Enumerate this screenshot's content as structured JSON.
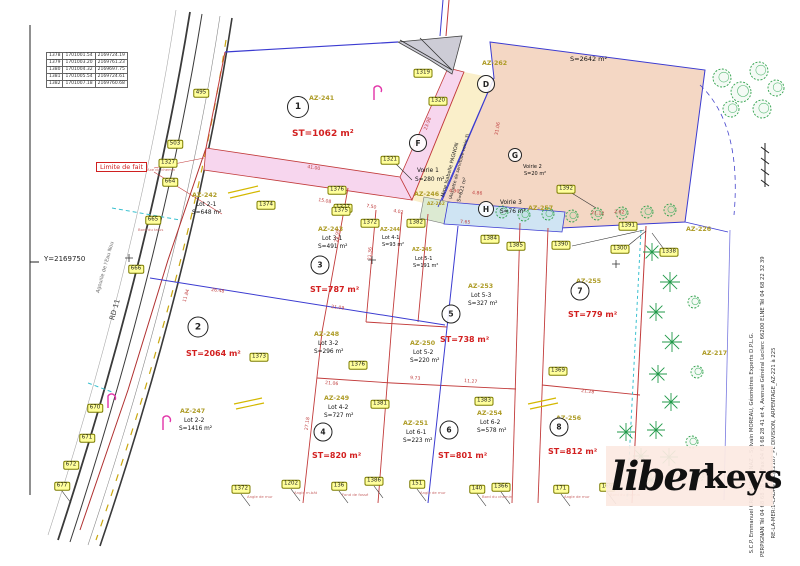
{
  "colors": {
    "red_line": "#c23b3b",
    "blue_line": "#3b3bd1",
    "pink_voirie": "#f7d6ee",
    "cream": "#faefca",
    "salmon": "#f4d7c4",
    "light_blue": "#cfe4f3",
    "green_tree": "#2fa14b",
    "point_yellow": "#ffff9c",
    "logo_bg": "#fbe9e2",
    "az_olive": "#ad9b25",
    "st_red": "#d21f1f"
  },
  "frame": {
    "y_label": "Y=2169750"
  },
  "road": {
    "rd": "RD 11",
    "stream": "Agouille de l'Eau Nou",
    "limite": "Limite de fait"
  },
  "coord_table": {
    "rows": [
      [
        "1378",
        "1701001.54",
        "2169724.19"
      ],
      [
        "1379",
        "1701003.20",
        "2169761.23"
      ],
      [
        "1380",
        "1701004.32",
        "2169697.75"
      ],
      [
        "1381",
        "1701005.54",
        "2169724.61"
      ],
      [
        "1382",
        "1701007.18",
        "2169760.68"
      ]
    ]
  },
  "logo": {
    "script": "liber",
    "bold": "keys"
  },
  "firm_lines": [
    "S.C.P. Emmanuel CRETIN-MAITENAZ - Sylvain MOREAU, Géomètres Experts D.P.L.G.",
    "PERPIGNAN Tél 04 68 68 28 40 - Fax 04 68 68 28 41 et 4, Avenue Général Leclerc 66200 ELNE Tél 04 68 22 32 39",
    "RE-LA-MER:1-CADASTRE/22187_PL DIVISION, ARPENTAGE_AZ-221 à 225"
  ],
  "pagnon": [
    "Mme Isabelle PAGNON",
    "(Assiette de servitude-voirie 3)",
    "S=621 m²"
  ],
  "circles": [
    {
      "n": "1",
      "x": 298,
      "y": 107,
      "d": 20
    },
    {
      "n": "2",
      "x": 198,
      "y": 327,
      "d": 19
    },
    {
      "n": "3",
      "x": 320,
      "y": 265,
      "d": 17
    },
    {
      "n": "4",
      "x": 323,
      "y": 432,
      "d": 17
    },
    {
      "n": "5",
      "x": 451,
      "y": 314,
      "d": 17
    },
    {
      "n": "6",
      "x": 449,
      "y": 430,
      "d": 17
    },
    {
      "n": "7",
      "x": 580,
      "y": 291,
      "d": 17
    },
    {
      "n": "8",
      "x": 559,
      "y": 427,
      "d": 17
    },
    {
      "n": "D",
      "x": 486,
      "y": 84,
      "d": 16
    },
    {
      "n": "F",
      "x": 418,
      "y": 143,
      "d": 16
    },
    {
      "n": "G",
      "x": 515,
      "y": 155,
      "d": 12
    },
    {
      "n": "H",
      "x": 486,
      "y": 209,
      "d": 14
    }
  ],
  "map_texts": [
    {
      "t": "AZ-241",
      "x": 309,
      "y": 96,
      "cls": "az"
    },
    {
      "t": "ST=1062 m²",
      "x": 292,
      "y": 130,
      "cls": "st",
      "f": 9
    },
    {
      "t": "AZ-242",
      "x": 192,
      "y": 193,
      "cls": "az"
    },
    {
      "t": "Lot 2-1",
      "x": 196,
      "y": 202,
      "cls": "k"
    },
    {
      "t": "S=648 m²",
      "x": 192,
      "y": 210,
      "cls": "k"
    },
    {
      "t": "AZ-243",
      "x": 318,
      "y": 227,
      "cls": "az"
    },
    {
      "t": "Lot 3-1",
      "x": 322,
      "y": 236,
      "cls": "k"
    },
    {
      "t": "S=491 m²",
      "x": 318,
      "y": 244,
      "cls": "k"
    },
    {
      "t": "AZ-244",
      "x": 380,
      "y": 228,
      "cls": "az",
      "f": 5
    },
    {
      "t": "Lot 4-1",
      "x": 382,
      "y": 236,
      "cls": "k",
      "f": 5
    },
    {
      "t": "S=93 m²",
      "x": 382,
      "y": 243,
      "cls": "k",
      "f": 5
    },
    {
      "t": "AZ-245",
      "x": 412,
      "y": 248,
      "cls": "az",
      "f": 5
    },
    {
      "t": "Lot 5-1",
      "x": 415,
      "y": 257,
      "cls": "k",
      "f": 5
    },
    {
      "t": "S=191 m²",
      "x": 413,
      "y": 264,
      "cls": "k",
      "f": 5
    },
    {
      "t": "AZ-246",
      "x": 414,
      "y": 192,
      "cls": "az"
    },
    {
      "t": "AZ-247",
      "x": 180,
      "y": 409,
      "cls": "az"
    },
    {
      "t": "Lot 2-2",
      "x": 184,
      "y": 418,
      "cls": "k"
    },
    {
      "t": "S=1416 m²",
      "x": 179,
      "y": 426,
      "cls": "k"
    },
    {
      "t": "AZ-248",
      "x": 314,
      "y": 332,
      "cls": "az"
    },
    {
      "t": "Lot 3-2",
      "x": 318,
      "y": 341,
      "cls": "k"
    },
    {
      "t": "S=296 m²",
      "x": 314,
      "y": 349,
      "cls": "k"
    },
    {
      "t": "AZ-249",
      "x": 324,
      "y": 396,
      "cls": "az"
    },
    {
      "t": "Lot 4-2",
      "x": 328,
      "y": 405,
      "cls": "k"
    },
    {
      "t": "S=727 m²",
      "x": 324,
      "y": 413,
      "cls": "k"
    },
    {
      "t": "AZ-250",
      "x": 410,
      "y": 341,
      "cls": "az"
    },
    {
      "t": "Lot 5-2",
      "x": 413,
      "y": 350,
      "cls": "k"
    },
    {
      "t": "S=220 m²",
      "x": 410,
      "y": 358,
      "cls": "k"
    },
    {
      "t": "AZ-251",
      "x": 403,
      "y": 421,
      "cls": "az"
    },
    {
      "t": "Lot 6-1",
      "x": 406,
      "y": 430,
      "cls": "k"
    },
    {
      "t": "S=223 m²",
      "x": 403,
      "y": 438,
      "cls": "k"
    },
    {
      "t": "AZ-252",
      "x": 427,
      "y": 203,
      "cls": "az",
      "f": 4.5
    },
    {
      "t": "AZ-253",
      "x": 468,
      "y": 284,
      "cls": "az"
    },
    {
      "t": "Lot 5-3",
      "x": 471,
      "y": 293,
      "cls": "k"
    },
    {
      "t": "S=327 m²",
      "x": 468,
      "y": 301,
      "cls": "k"
    },
    {
      "t": "AZ-254",
      "x": 477,
      "y": 411,
      "cls": "az"
    },
    {
      "t": "Lot 6-2",
      "x": 480,
      "y": 420,
      "cls": "k"
    },
    {
      "t": "S=578 m²",
      "x": 477,
      "y": 428,
      "cls": "k"
    },
    {
      "t": "AZ-255",
      "x": 576,
      "y": 279,
      "cls": "az"
    },
    {
      "t": "AZ-256",
      "x": 556,
      "y": 416,
      "cls": "az"
    },
    {
      "t": "AZ-257",
      "x": 528,
      "y": 206,
      "cls": "az"
    },
    {
      "t": "AZ-262",
      "x": 482,
      "y": 61,
      "cls": "az"
    },
    {
      "t": "AZ-226",
      "x": 686,
      "y": 227,
      "cls": "az"
    },
    {
      "t": "AZ-217",
      "x": 702,
      "y": 351,
      "cls": "az"
    },
    {
      "t": "ST=2064 m²",
      "x": 186,
      "y": 350,
      "cls": "st"
    },
    {
      "t": "ST=787 m²",
      "x": 310,
      "y": 286,
      "cls": "st"
    },
    {
      "t": "ST=820 m²",
      "x": 312,
      "y": 452,
      "cls": "st"
    },
    {
      "t": "ST=738 m²",
      "x": 440,
      "y": 336,
      "cls": "st"
    },
    {
      "t": "ST=801 m²",
      "x": 438,
      "y": 452,
      "cls": "st"
    },
    {
      "t": "ST=779 m²",
      "x": 568,
      "y": 311,
      "cls": "st"
    },
    {
      "t": "ST=812 m²",
      "x": 548,
      "y": 448,
      "cls": "st"
    },
    {
      "t": "Voirie 1",
      "x": 417,
      "y": 168,
      "cls": "k"
    },
    {
      "t": "S=280 m²",
      "x": 415,
      "y": 177,
      "cls": "k"
    },
    {
      "t": "Voirie 2",
      "x": 523,
      "y": 165,
      "cls": "k",
      "f": 5
    },
    {
      "t": "S=20 m²",
      "x": 524,
      "y": 172,
      "cls": "k",
      "f": 5
    },
    {
      "t": "Voirie 3",
      "x": 500,
      "y": 200,
      "cls": "k"
    },
    {
      "t": "S=76 m²",
      "x": 500,
      "y": 209,
      "cls": "k"
    },
    {
      "t": "S=2642 m²",
      "x": 570,
      "y": 56,
      "cls": "k",
      "f": 6.5
    },
    {
      "t": "41.00",
      "x": 307,
      "y": 166,
      "cls": "dim",
      "r": 9
    },
    {
      "t": "15.08",
      "x": 318,
      "y": 199,
      "cls": "dim",
      "r": 10
    },
    {
      "t": "7.50",
      "x": 366,
      "y": 205,
      "cls": "dim",
      "r": 10
    },
    {
      "t": "4.02",
      "x": 393,
      "y": 210,
      "cls": "dim",
      "r": 10
    },
    {
      "t": "26.48",
      "x": 211,
      "y": 289,
      "cls": "dim",
      "r": 7
    },
    {
      "t": "21.09",
      "x": 331,
      "y": 306,
      "cls": "dim",
      "r": 7
    },
    {
      "t": "23.95",
      "x": 338,
      "y": 240,
      "cls": "dim",
      "r": -82
    },
    {
      "t": "21.36",
      "x": 371,
      "y": 258,
      "cls": "dim",
      "r": -85
    },
    {
      "t": "27.18",
      "x": 308,
      "y": 428,
      "cls": "dim",
      "r": -82
    },
    {
      "t": "21.06",
      "x": 325,
      "y": 382,
      "cls": "dim",
      "r": 5
    },
    {
      "t": "9.73",
      "x": 410,
      "y": 377,
      "cls": "dim",
      "r": 5
    },
    {
      "t": "11.27",
      "x": 464,
      "y": 380,
      "cls": "dim",
      "r": 5
    },
    {
      "t": "21.28",
      "x": 581,
      "y": 390,
      "cls": "dim",
      "r": 6
    },
    {
      "t": "21.12",
      "x": 591,
      "y": 212,
      "cls": "dim",
      "r": 4
    },
    {
      "t": "2.62",
      "x": 614,
      "y": 211,
      "cls": "dim",
      "r": 4
    },
    {
      "t": "4.90",
      "x": 449,
      "y": 190,
      "cls": "dim",
      "r": 4
    },
    {
      "t": "4.86",
      "x": 472,
      "y": 192,
      "cls": "dim",
      "r": 4
    },
    {
      "t": "7.65",
      "x": 460,
      "y": 221,
      "cls": "dim",
      "r": 4
    },
    {
      "t": "23.98",
      "x": 427,
      "y": 128,
      "cls": "dim",
      "r": -70
    },
    {
      "t": "31.06",
      "x": 498,
      "y": 133,
      "cls": "dim",
      "r": -80
    },
    {
      "t": "11.84",
      "x": 186,
      "y": 300,
      "cls": "dim",
      "r": -74
    },
    {
      "t": "Axe du chemin",
      "x": 147,
      "y": 168,
      "cls": "note"
    },
    {
      "t": "Bord du talus",
      "x": 138,
      "y": 228,
      "cls": "note"
    },
    {
      "t": "Angle de mur",
      "x": 247,
      "y": 495,
      "cls": "note"
    },
    {
      "t": "Angle m.bât",
      "x": 294,
      "y": 491,
      "cls": "note"
    },
    {
      "t": "Fond de fossé",
      "x": 342,
      "y": 493,
      "cls": "note"
    },
    {
      "t": "Angle de mur",
      "x": 420,
      "y": 491,
      "cls": "note"
    },
    {
      "t": "Bord du chemin",
      "x": 482,
      "y": 495,
      "cls": "note"
    },
    {
      "t": "Angle de mur",
      "x": 564,
      "y": 495,
      "cls": "note"
    },
    {
      "t": "Bord du chemin",
      "x": 610,
      "y": 493,
      "cls": "note"
    }
  ],
  "points": [
    {
      "t": "495",
      "x": 201,
      "y": 93
    },
    {
      "t": "503",
      "x": 175,
      "y": 144
    },
    {
      "t": "1327",
      "x": 168,
      "y": 163
    },
    {
      "t": "664",
      "x": 170,
      "y": 182
    },
    {
      "t": "665",
      "x": 153,
      "y": 220
    },
    {
      "t": "666",
      "x": 136,
      "y": 269
    },
    {
      "t": "670",
      "x": 95,
      "y": 408
    },
    {
      "t": "671",
      "x": 87,
      "y": 438
    },
    {
      "t": "672",
      "x": 71,
      "y": 465
    },
    {
      "t": "677",
      "x": 62,
      "y": 486
    },
    {
      "t": "1319",
      "x": 423,
      "y": 73
    },
    {
      "t": "1320",
      "x": 438,
      "y": 101
    },
    {
      "t": "1321",
      "x": 390,
      "y": 160
    },
    {
      "t": "1376",
      "x": 337,
      "y": 190
    },
    {
      "t": "1377",
      "x": 343,
      "y": 208
    },
    {
      "t": "1374",
      "x": 266,
      "y": 205
    },
    {
      "t": "1375",
      "x": 341,
      "y": 211
    },
    {
      "t": "1372",
      "x": 370,
      "y": 223
    },
    {
      "t": "1382",
      "x": 416,
      "y": 223
    },
    {
      "t": "1384",
      "x": 490,
      "y": 239
    },
    {
      "t": "1385",
      "x": 516,
      "y": 246
    },
    {
      "t": "1390",
      "x": 561,
      "y": 245
    },
    {
      "t": "1391",
      "x": 628,
      "y": 226
    },
    {
      "t": "1392",
      "x": 566,
      "y": 189
    },
    {
      "t": "1300",
      "x": 620,
      "y": 249
    },
    {
      "t": "1338",
      "x": 669,
      "y": 252
    },
    {
      "t": "1373",
      "x": 259,
      "y": 357
    },
    {
      "t": "1376",
      "x": 358,
      "y": 365
    },
    {
      "t": "1381",
      "x": 380,
      "y": 404
    },
    {
      "t": "1369",
      "x": 558,
      "y": 371
    },
    {
      "t": "1383",
      "x": 484,
      "y": 401
    },
    {
      "t": "1372",
      "x": 241,
      "y": 489
    },
    {
      "t": "1202",
      "x": 291,
      "y": 484
    },
    {
      "t": "136",
      "x": 339,
      "y": 486
    },
    {
      "t": "1386",
      "x": 374,
      "y": 481
    },
    {
      "t": "151",
      "x": 417,
      "y": 484
    },
    {
      "t": "140",
      "x": 477,
      "y": 489
    },
    {
      "t": "1366",
      "x": 501,
      "y": 487
    },
    {
      "t": "171",
      "x": 561,
      "y": 489
    },
    {
      "t": "169",
      "x": 607,
      "y": 487
    }
  ],
  "trees": [
    {
      "x": 722,
      "y": 78,
      "r": 9,
      "k": "r"
    },
    {
      "x": 741,
      "y": 92,
      "r": 10,
      "k": "r"
    },
    {
      "x": 759,
      "y": 71,
      "r": 9,
      "k": "r"
    },
    {
      "x": 731,
      "y": 109,
      "r": 8,
      "k": "r"
    },
    {
      "x": 762,
      "y": 109,
      "r": 9,
      "k": "r"
    },
    {
      "x": 776,
      "y": 88,
      "r": 8,
      "k": "r"
    },
    {
      "x": 502,
      "y": 212,
      "r": 6,
      "k": "r"
    },
    {
      "x": 524,
      "y": 215,
      "r": 6,
      "k": "r"
    },
    {
      "x": 548,
      "y": 214,
      "r": 6,
      "k": "r"
    },
    {
      "x": 572,
      "y": 216,
      "r": 6,
      "k": "r"
    },
    {
      "x": 597,
      "y": 214,
      "r": 6,
      "k": "r"
    },
    {
      "x": 622,
      "y": 213,
      "r": 6,
      "k": "r"
    },
    {
      "x": 647,
      "y": 212,
      "r": 6,
      "k": "r"
    },
    {
      "x": 670,
      "y": 210,
      "r": 6,
      "k": "r"
    },
    {
      "x": 652,
      "y": 252,
      "r": 9,
      "k": "p"
    },
    {
      "x": 670,
      "y": 282,
      "r": 10,
      "k": "p"
    },
    {
      "x": 656,
      "y": 312,
      "r": 9,
      "k": "p"
    },
    {
      "x": 672,
      "y": 342,
      "r": 10,
      "k": "p"
    },
    {
      "x": 658,
      "y": 374,
      "r": 9,
      "k": "p"
    },
    {
      "x": 671,
      "y": 402,
      "r": 9,
      "k": "p"
    },
    {
      "x": 656,
      "y": 430,
      "r": 9,
      "k": "p"
    },
    {
      "x": 669,
      "y": 457,
      "r": 9,
      "k": "p"
    },
    {
      "x": 651,
      "y": 480,
      "r": 8,
      "k": "p"
    },
    {
      "x": 694,
      "y": 302,
      "r": 6,
      "k": "r"
    },
    {
      "x": 697,
      "y": 372,
      "r": 6,
      "k": "r"
    },
    {
      "x": 692,
      "y": 442,
      "r": 6,
      "k": "r"
    },
    {
      "x": 699,
      "y": 476,
      "r": 5,
      "k": "r"
    },
    {
      "x": 626,
      "y": 432,
      "r": 9,
      "k": "p"
    },
    {
      "x": 641,
      "y": 456,
      "r": 8,
      "k": "p"
    }
  ]
}
